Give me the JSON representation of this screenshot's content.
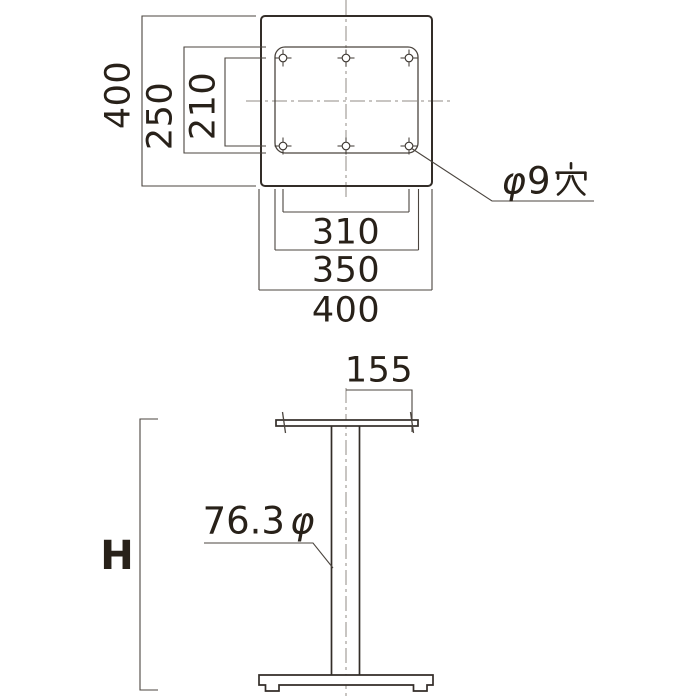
{
  "colors": {
    "background": "#ffffff",
    "outline": "#332d28",
    "dimension_line": "#4b453f",
    "centerline": "#918b85",
    "text": "#282119"
  },
  "top_view": {
    "dim_overall_vertical": "400",
    "dim_plate_vertical": "250",
    "dim_hole_pitch_vertical": "210",
    "dim_hole_pitch_horizontal": "310",
    "dim_plate_horizontal": "350",
    "dim_overall_horizontal": "400",
    "hole_note": "φ9穴",
    "hole_note_phi": "φ",
    "hole_note_digit": "9",
    "hole_note_kanji": "穴",
    "hole_count": 6
  },
  "side_view": {
    "dim_top_plate": "155",
    "column_note": "76.3φ",
    "column_note_value": "76.3",
    "column_note_phi": "φ",
    "dim_height": "H"
  }
}
